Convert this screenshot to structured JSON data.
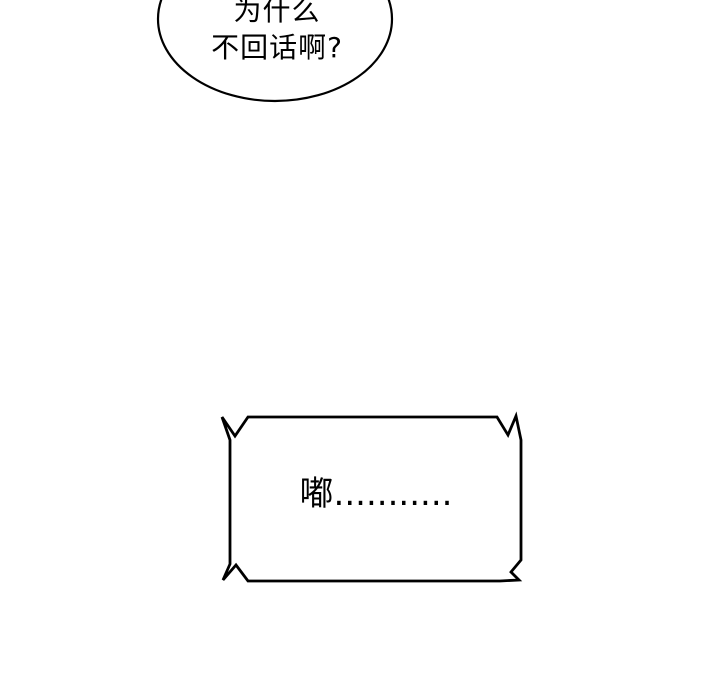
{
  "panel": {
    "background_color": "#ffffff",
    "ink_color": "#000000",
    "speech_bubble": {
      "line1": "为什么",
      "line2": "不回话啊?"
    },
    "sound_bubble": {
      "text": "嘟..........."
    }
  }
}
